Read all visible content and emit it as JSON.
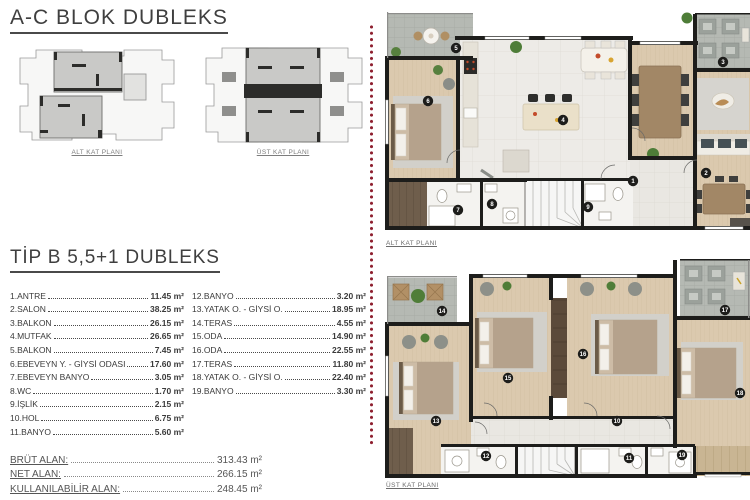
{
  "page": {
    "title": "A-C BLOK DUBLEKS",
    "subtitle": "TİP B 5,5+1 DUBLEKS"
  },
  "key_plans": [
    {
      "label": "ALT KAT PLANI"
    },
    {
      "label": "ÜST KAT PLANI"
    }
  ],
  "room_list": {
    "columns": [
      [
        {
          "no": "1",
          "name": "ANTRE",
          "area": "11.45 m²"
        },
        {
          "no": "2",
          "name": "SALON",
          "area": "38.25 m²"
        },
        {
          "no": "3",
          "name": "BALKON",
          "area": "26.15 m²"
        },
        {
          "no": "4",
          "name": "MUTFAK",
          "area": "26.65 m²"
        },
        {
          "no": "5",
          "name": "BALKON",
          "area": "7.45 m²"
        },
        {
          "no": "6",
          "name": "EBEVEYN Y. - GİYSİ ODASI",
          "area": "17.60 m²"
        },
        {
          "no": "7",
          "name": "EBEVEYN BANYO",
          "area": "3.05 m²"
        },
        {
          "no": "8",
          "name": "WC",
          "area": "1.70 m²"
        },
        {
          "no": "9",
          "name": "İŞLİK",
          "area": "2.15 m²"
        },
        {
          "no": "10",
          "name": "HOL",
          "area": "6.75 m²"
        },
        {
          "no": "11",
          "name": "BANYO",
          "area": "5.60 m²"
        }
      ],
      [
        {
          "no": "12",
          "name": "BANYO",
          "area": "3.20 m²"
        },
        {
          "no": "13",
          "name": "YATAK O. - GİYSİ O.",
          "area": "18.95 m²"
        },
        {
          "no": "14",
          "name": "TERAS",
          "area": "4.55 m²"
        },
        {
          "no": "15",
          "name": "ODA",
          "area": "14.90 m²"
        },
        {
          "no": "16",
          "name": "ODA",
          "area": "22.55 m²"
        },
        {
          "no": "17",
          "name": "TERAS",
          "area": "11.80 m²"
        },
        {
          "no": "18",
          "name": "YATAK O. - GİYSİ O.",
          "area": "22.40 m²"
        },
        {
          "no": "19",
          "name": "BANYO",
          "area": "3.30 m²"
        }
      ]
    ]
  },
  "summary": [
    {
      "label": "BRÜT ALAN:",
      "value": "313.43 m²"
    },
    {
      "label": "NET ALAN:",
      "value": "266.15 m²"
    },
    {
      "label": "KULLANILABİLİR ALAN:",
      "value": "248.45 m²"
    }
  ],
  "plans": [
    {
      "label": "ALT KAT PLANI",
      "badges": [
        {
          "n": "5",
          "x": 71,
          "y": 40
        },
        {
          "n": "6",
          "x": 43,
          "y": 93
        },
        {
          "n": "4",
          "x": 178,
          "y": 112
        },
        {
          "n": "3",
          "x": 338,
          "y": 54
        },
        {
          "n": "1",
          "x": 248,
          "y": 173
        },
        {
          "n": "2",
          "x": 321,
          "y": 165
        },
        {
          "n": "7",
          "x": 73,
          "y": 202
        },
        {
          "n": "8",
          "x": 107,
          "y": 196
        },
        {
          "n": "9",
          "x": 203,
          "y": 199
        }
      ]
    },
    {
      "label": "ÜST KAT PLANI",
      "badges": [
        {
          "n": "14",
          "x": 57,
          "y": 55
        },
        {
          "n": "13",
          "x": 51,
          "y": 165
        },
        {
          "n": "15",
          "x": 123,
          "y": 122
        },
        {
          "n": "16",
          "x": 198,
          "y": 98
        },
        {
          "n": "17",
          "x": 340,
          "y": 54
        },
        {
          "n": "18",
          "x": 355,
          "y": 137
        },
        {
          "n": "10",
          "x": 232,
          "y": 165
        },
        {
          "n": "12",
          "x": 101,
          "y": 200
        },
        {
          "n": "11",
          "x": 244,
          "y": 202
        },
        {
          "n": "19",
          "x": 297,
          "y": 199
        }
      ]
    }
  ],
  "colors": {
    "accent_dots": "#8e1f2f",
    "wall": "#1d1d1b",
    "wood_floor": "#dbc9ae",
    "tile_floor": "#edebe7",
    "terrace": "#b5b9b3",
    "deck": "#6f5e4c",
    "badge": "#1d1d1b"
  }
}
